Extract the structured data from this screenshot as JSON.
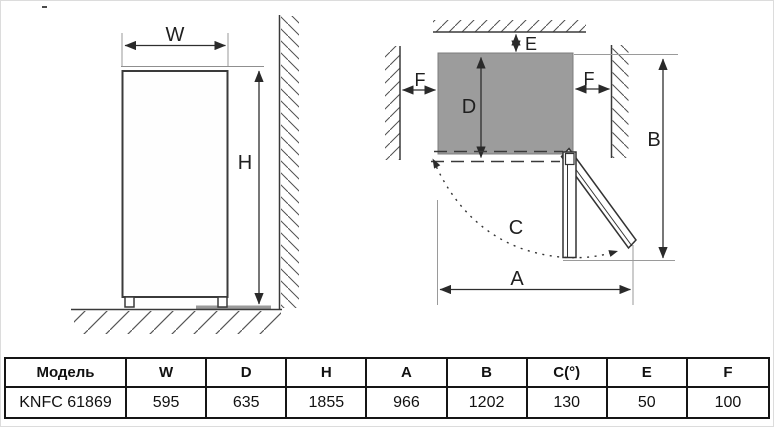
{
  "diagram": {
    "front_view": {
      "width_label": "W",
      "height_label": "H"
    },
    "top_view": {
      "depth_label": "D",
      "top_gap_label": "E",
      "left_gap_label": "F",
      "right_gap_label": "F",
      "total_depth_label": "B",
      "door_swing_label": "C",
      "door_width_label": "A"
    }
  },
  "table": {
    "headers": [
      "Модель",
      "W",
      "D",
      "H",
      "A",
      "B",
      "C(°)",
      "E",
      "F"
    ],
    "rows": [
      [
        "KNFC 61869",
        "595",
        "635",
        "1855",
        "966",
        "1202",
        "130",
        "50",
        "100"
      ]
    ]
  },
  "colors": {
    "cabinet_fill": "#9c9c9c",
    "line": "#2e2e2e"
  }
}
